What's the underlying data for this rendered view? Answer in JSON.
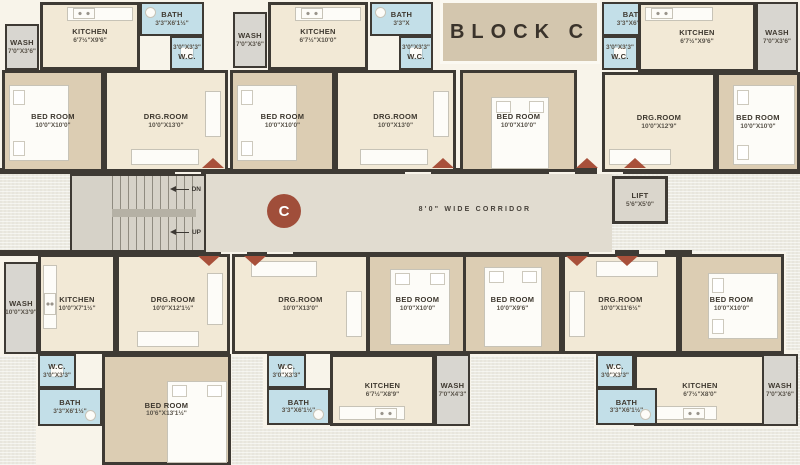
{
  "title": {
    "text": "BLOCK C"
  },
  "corridor": {
    "badge": "C",
    "label": "8'0\" WIDE CORRIDOR",
    "down": "DN",
    "up": "UP"
  },
  "lift": {
    "name": "LIFT",
    "dims": "5'6\"X5'0\""
  },
  "palette": {
    "wall": "#3e3a34",
    "room_cream": "#f2e9d6",
    "bedroom_tan": "#dccdb3",
    "bath_blue": "#c3dfe8",
    "wash_gray": "#d8d6d0",
    "corridor_floor": "#e1dcd0",
    "door_marker_red": "#a8503a",
    "badge_red": "#a04e3a",
    "title_box": "#d3c6ae"
  },
  "rooms": [
    {
      "n": "WASH",
      "d": "7'0\"X3'6\""
    },
    {
      "n": "KITCHEN",
      "d": "6'7½\"X9'6\""
    },
    {
      "n": "BATH",
      "d": "3'3\"X6'1½\""
    },
    {
      "n": "W.C.",
      "d": "3'0\"X3'3\""
    },
    {
      "n": "BED ROOM",
      "d": "10'0\"X10'0\""
    },
    {
      "n": "DRG.ROOM",
      "d": "10'0\"X13'0\""
    },
    {
      "n": "WASH",
      "d": "7'0\"X3'6\""
    },
    {
      "n": "KITCHEN",
      "d": "6'7½\"X10'0\""
    },
    {
      "n": "BATH",
      "d": "3'3\"X"
    },
    {
      "n": "W.C.",
      "d": "3'0\"X3'3\""
    },
    {
      "n": "BED ROOM",
      "d": "10'0\"X10'0\""
    },
    {
      "n": "DRG.ROOM",
      "d": "10'0\"X13'0\""
    },
    {
      "n": "BED ROOM",
      "d": "10'0\"X10'0\""
    },
    {
      "n": "BATH",
      "d": "3'3\"X6'1½\""
    },
    {
      "n": "W.C.",
      "d": "3'0\"X3'3\""
    },
    {
      "n": "KITCHEN",
      "d": "6'7½\"X9'6\""
    },
    {
      "n": "WASH",
      "d": "7'0\"X3'6\""
    },
    {
      "n": "DRG.ROOM",
      "d": "10'0\"X12'9\""
    },
    {
      "n": "BED ROOM",
      "d": "10'0\"X10'0\""
    },
    {
      "n": "WASH",
      "d": "10'0\"X3'9\""
    },
    {
      "n": "KITCHEN",
      "d": "10'0\"X7'1½\""
    },
    {
      "n": "DRG.ROOM",
      "d": "10'0\"X12'1½\""
    },
    {
      "n": "W.C.",
      "d": "3'0\"X3'3\""
    },
    {
      "n": "BATH",
      "d": "3'3\"X6'1½\""
    },
    {
      "n": "BED ROOM",
      "d": "10'6\"X13'1½\""
    },
    {
      "n": "DRG.ROOM",
      "d": "10'0\"X13'0\""
    },
    {
      "n": "BED ROOM",
      "d": "10'0\"X10'0\""
    },
    {
      "n": "W.C.",
      "d": "3'0\"X3'3\""
    },
    {
      "n": "BATH",
      "d": "3'3\"X6'1½\""
    },
    {
      "n": "KITCHEN",
      "d": "6'7½\"X8'9\""
    },
    {
      "n": "WASH",
      "d": "7'0\"X4'3\""
    },
    {
      "n": "BED ROOM",
      "d": "10'0\"X9'6\""
    },
    {
      "n": "DRG.ROOM",
      "d": "10'0\"X11'6½\""
    },
    {
      "n": "W.C.",
      "d": "3'0\"X3'3\""
    },
    {
      "n": "BATH",
      "d": "3'3\"X6'1½\""
    },
    {
      "n": "BED ROOM",
      "d": "10'0\"X10'0\""
    },
    {
      "n": "KITCHEN",
      "d": "6'7½\"X8'0\""
    },
    {
      "n": "WASH",
      "d": "7'0\"X3'6\""
    }
  ]
}
